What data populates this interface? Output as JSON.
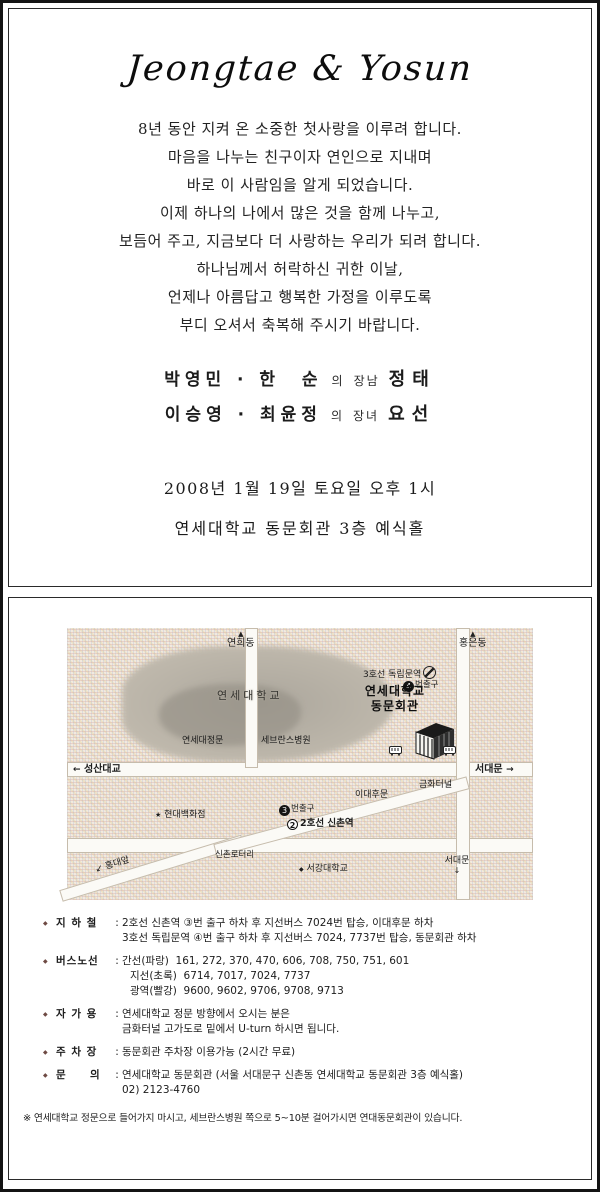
{
  "colors": {
    "paper": "#ffffff",
    "ink": "#1c1c1c",
    "map_bg": "#f2e9df",
    "campus_gray": "#aba69c"
  },
  "icons": {
    "arrow_up": "▲",
    "arrow_left": "←",
    "arrow_right": "→",
    "arrow_down": "↓",
    "arrow_down_left": "↙",
    "star": "★",
    "marker": "◆",
    "bullet": "◆"
  },
  "invitation": {
    "title": "Jeongtae & Yosun",
    "message_lines": [
      "8년 동안 지켜 온 소중한 첫사랑을 이루려 합니다.",
      "마음을 나누는 친구이자 연인으로 지내며",
      "바로 이 사람임을 알게 되었습니다.",
      "이제 하나의 나에서 많은 것을 함께 나누고,",
      "보듬어 주고, 지금보다 더 사랑하는 우리가 되려 합니다.",
      "하나님께서 허락하신 귀한 이날,",
      "언제나 아름답고 행복한 가정을 이루도록",
      "부디 오셔서 축복해 주시기 바랍니다."
    ],
    "groom_line": {
      "parents": "박영민 · 한  순",
      "relation_of": "의",
      "relation": "장남",
      "name": "정태"
    },
    "bride_line": {
      "parents": "이승영 · 최윤정",
      "relation_of": "의",
      "relation": "장녀",
      "name": "요선"
    },
    "datetime": "2008년 1월 19일 토요일 오후 1시",
    "venue": "연세대학교 동문회관 3층 예식홀"
  },
  "map": {
    "north_left": "연희동",
    "north_right": "홍은동",
    "dongnimmun_station": "3호선 독립문역",
    "dongnimmun_exit_no": "4",
    "dongnimmun_exit": "번출구",
    "campus": "연세대학교",
    "hall_line1": "연세대학교",
    "hall_line2": "동문회관",
    "main_gate": "연세대정문",
    "hospital": "세브란스병원",
    "west": "성산대교",
    "east": "서대문",
    "tunnel": "금화터널",
    "ewha_back_gate": "이대후문",
    "sinchon_exit_no": "3",
    "sinchon_exit": "번출구",
    "sinchon_line_no": "2",
    "sinchon_station": "2호선 신촌역",
    "dept_store": "현대백화점",
    "rotary": "신촌로터리",
    "sogang": "서강대학교",
    "southwest": "홍대앞",
    "south": "서대문"
  },
  "directions": {
    "subway_label": "지 하 철",
    "subway_1": "2호선 신촌역 ③번 출구 하차 후 지선버스 7024번 탑승, 이대후문 하차",
    "subway_2": "3호선 독립문역 ④번 출구 하차 후 지선버스 7024, 7737번 탑승, 동문회관 하차",
    "bus_label": "버스노선",
    "bus_1": "간선(파랑)  161, 272, 370, 470, 606, 708, 750, 751, 601",
    "bus_2": "지선(초록)  6714, 7017, 7024, 7737",
    "bus_3": "광역(빨강)  9600, 9602, 9706, 9708, 9713",
    "car_label": "자 가 용",
    "car_1": "연세대학교 정문 방향에서 오시는 분은",
    "car_2": "금화터널 고가도로 밑에서 U-turn 하시면 됩니다.",
    "parking_label": "주 차 장",
    "parking_1": "동문회관 주차장 이용가능 (2시간 무료)",
    "inquiry_label": "문     의",
    "inquiry_1": "연세대학교 동문회관 (서울 서대문구 신촌동 연세대학교 동문회관 3층 예식홀)",
    "inquiry_2": "02) 2123-4760",
    "note": "※ 연세대학교 정문으로 들어가지 마시고, 세브란스병원 쪽으로 5~10분 걸어가시면 연대동문회관이 있습니다."
  }
}
